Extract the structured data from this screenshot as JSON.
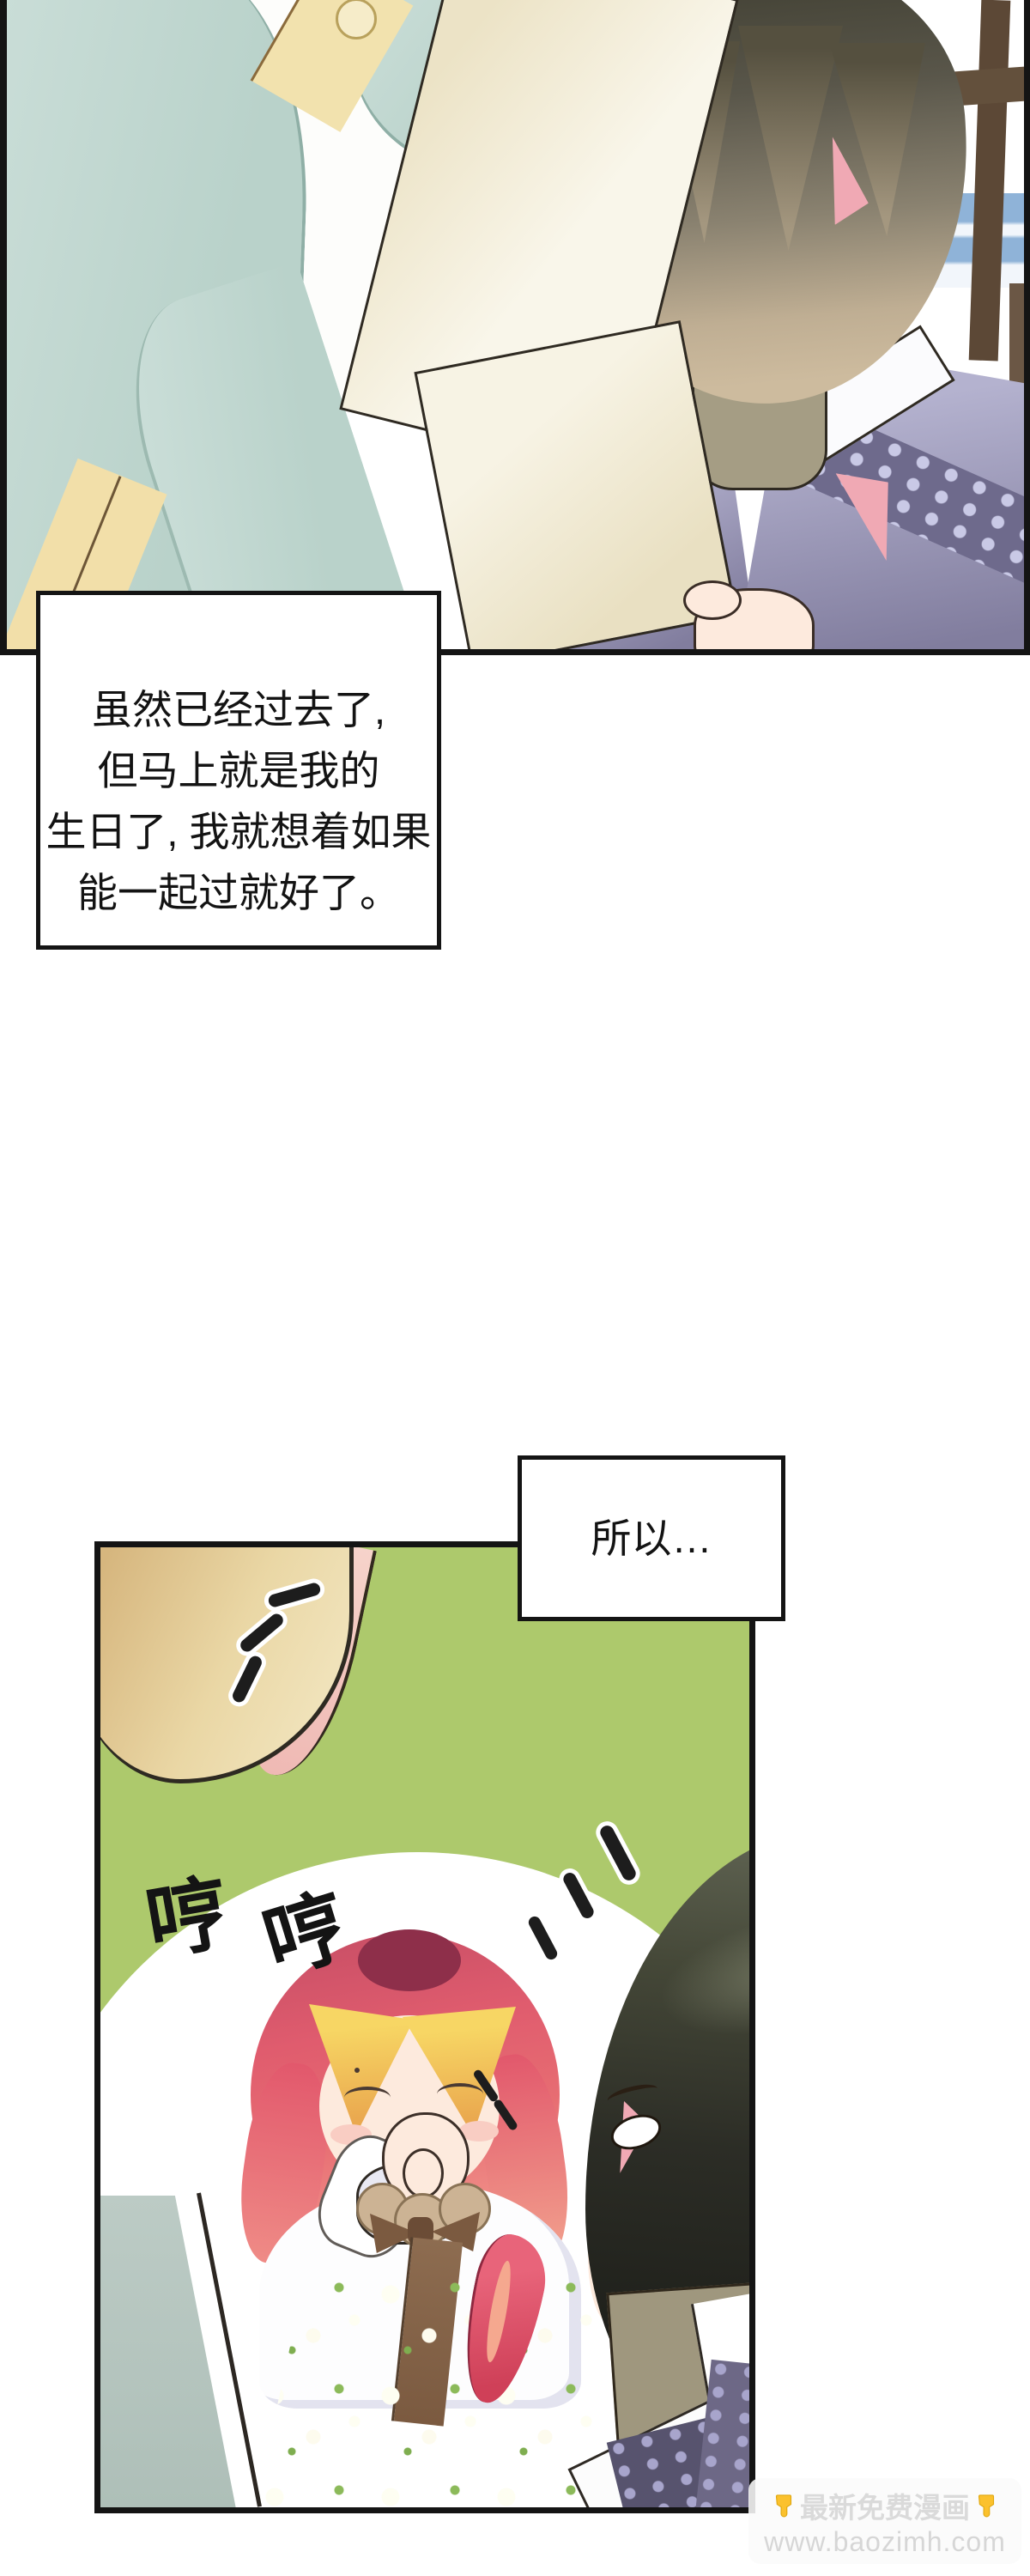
{
  "page": {
    "type": "webtoon-comic-page",
    "panel_count": 2
  },
  "speech1": {
    "lines": [
      "虽然已经过去了,",
      "但马上就是我的",
      "生日了, 我就想着如果",
      "能一起过就好了。"
    ]
  },
  "speech2": {
    "text": "所以…"
  },
  "sfx": {
    "giggle_char1": "哼",
    "giggle_char2": "哼"
  },
  "watermark": {
    "line1": "最新免费漫画",
    "line2": "www.baozimh.com"
  },
  "colors": {
    "panel_border": "#141414",
    "panel2_background_green": "#adc96c",
    "speech_box_background": "#ffffff",
    "speech_text": "#131313",
    "mint_coat": "#c0d6cf",
    "cream_trim": "#f2dfa9",
    "speaker_hair_dark": "#3f3e31",
    "speaker_hair_tan": "#cdbb9e",
    "pink_inner_hair": "#f0a9b4",
    "skin": "#fdeadd",
    "eye_blue": "#2a3f8f",
    "robe_lavender": "#b4b2cf",
    "robe_dark_purple": "#57536e",
    "robe_pattern_light": "#c9c9e6",
    "girl_hair_red": "#e05c6e",
    "girl_bangs_blonde": "#f0c05a",
    "skirt_mauve": "#bb968e",
    "sage_sleeve": "#b5c6c0",
    "watermark_text": "#d8d8d8",
    "watermark_hand_yellow": "#fbc12d"
  }
}
